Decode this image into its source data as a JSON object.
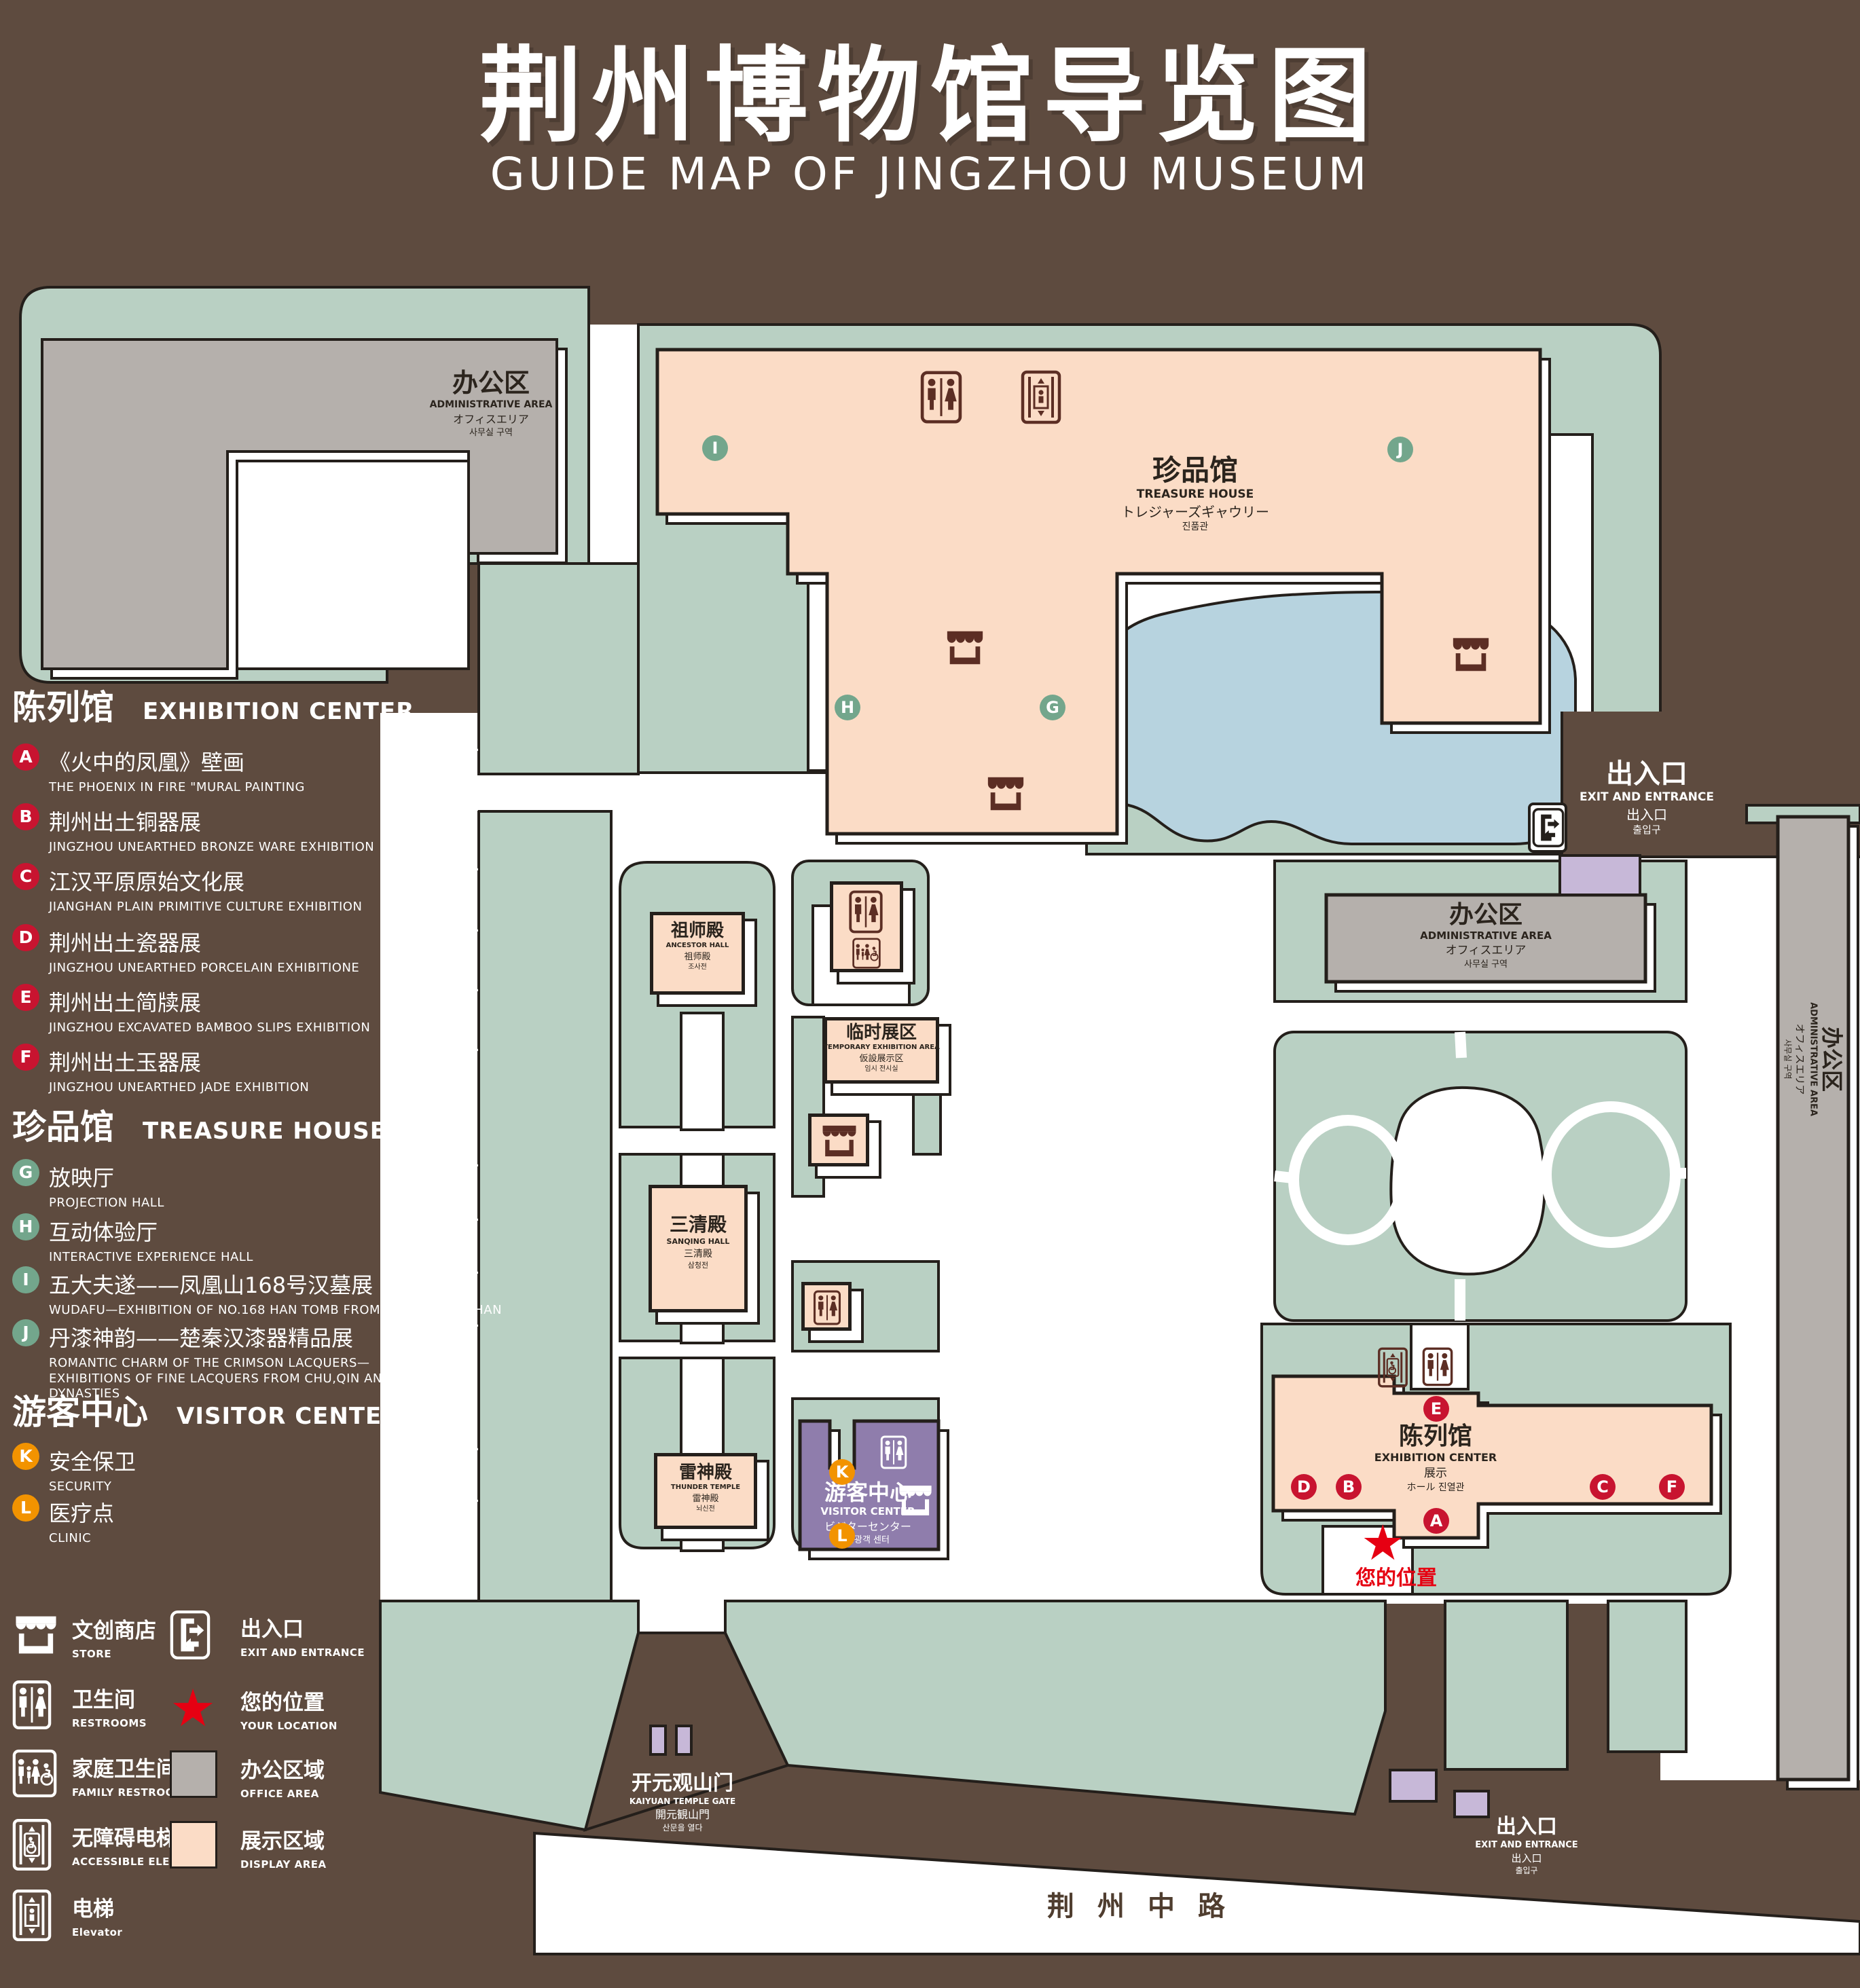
{
  "title": {
    "zh": "荆州博物馆导览图",
    "en": "GUIDE MAP OF JINGZHOU MUSEUM"
  },
  "colors": {
    "background": "#5E4B3F",
    "grounds_green": "#B9D0C3",
    "display_area": "#FBDCC6",
    "office_area": "#B5B0AC",
    "lake_blue": "#B7D3DF",
    "visitor_purple": "#8F7DAC",
    "gate_purple": "#C7B8D8",
    "marker_red": "#C81430",
    "marker_green": "#73A68C",
    "marker_orange": "#F29300",
    "location_red": "#E60012",
    "outline": "#241f1b"
  },
  "legend": {
    "sections": [
      {
        "zh": "陈列馆",
        "en": "EXHIBITION CENTER",
        "color": "#C81430",
        "items": [
          {
            "letter": "A",
            "zh": "《火中的凤凰》壁画",
            "en": "THE PHOENIX IN FIRE \"MURAL PAINTING",
            "floor": "1F"
          },
          {
            "letter": "B",
            "zh": "荆州出土铜器展",
            "en": "JINGZHOU UNEARTHED BRONZE WARE EXHIBITION",
            "floor": "1F"
          },
          {
            "letter": "C",
            "zh": "江汉平原原始文化展",
            "en": "JIANGHAN PLAIN PRIMITIVE CULTURE EXHIBITION",
            "floor": "1F"
          },
          {
            "letter": "D",
            "zh": "荆州出土瓷器展",
            "en": "JINGZHOU UNEARTHED PORCELAIN EXHIBITIONE",
            "floor": "2F"
          },
          {
            "letter": "E",
            "zh": "荆州出土简牍展",
            "en": "JINGZHOU EXCAVATED BAMBOO SLIPS EXHIBITION",
            "floor": "2F"
          },
          {
            "letter": "F",
            "zh": "荆州出土玉器展",
            "en": "JINGZHOU UNEARTHED JADE EXHIBITION",
            "floor": "2F"
          }
        ]
      },
      {
        "zh": "珍品馆",
        "en": "TREASURE HOUSE",
        "color": "#73A68C",
        "items": [
          {
            "letter": "G",
            "zh": "放映厅",
            "en": "PROJECTION HALL",
            "floor": "1F"
          },
          {
            "letter": "H",
            "zh": "互动体验厅",
            "en": "INTERACTIVE EXPERIENCE HALL",
            "floor": "1F"
          },
          {
            "letter": "I",
            "zh": "五大夫遂——凤凰山168号汉墓展",
            "en": "WUDAFU—EXHIBITION OF NO.168 HAN TOMB FROM FENGHUANGSHAN",
            "floor": "2F"
          },
          {
            "letter": "J",
            "zh": "丹漆神韵——楚秦汉漆器精品展",
            "en": "ROMANTIC CHARM OF THE CRIMSON LACQUERS—EXHIBITIONS OF FINE LACQUERS FROM CHU,QIN AND HAN DYNASTIES",
            "floor": "1-2F"
          }
        ]
      },
      {
        "zh": "游客中心",
        "en": "VISITOR CENTER",
        "color": "#F29300",
        "items": [
          {
            "letter": "K",
            "zh": "安全保卫",
            "en": "SECURITY",
            "floor": "1F"
          },
          {
            "letter": "L",
            "zh": "医疗点",
            "en": "CLINIC",
            "floor": "1F"
          }
        ]
      }
    ],
    "facilities_left": [
      {
        "icon": "store-icon",
        "zh": "文创商店",
        "en": "STORE"
      },
      {
        "icon": "restrooms-icon",
        "zh": "卫生间",
        "en": "RESTROOMS"
      },
      {
        "icon": "family-restrooms-icon",
        "zh": "家庭卫生间",
        "en": "FAMILY RESTROOMS"
      },
      {
        "icon": "accessible-elevator-icon",
        "zh": "无障碍电梯",
        "en": "ACCESSIBLE ELEVATOR"
      },
      {
        "icon": "elevator-icon",
        "zh": "电梯",
        "en": "Elevator"
      }
    ],
    "facilities_right": [
      {
        "icon": "exit-icon",
        "zh": "出入口",
        "en": "EXIT AND ENTRANCE"
      },
      {
        "icon": "location-star",
        "zh": "您的位置",
        "en": "YOUR LOCATION"
      },
      {
        "icon": "office-swatch",
        "zh": "办公区域",
        "en": "OFFICE AREA"
      },
      {
        "icon": "display-swatch",
        "zh": "展示区域",
        "en": "DISPLAY AREA"
      }
    ]
  },
  "map": {
    "admin": {
      "zh": "办公区",
      "en": "ADMINISTRATIVE AREA",
      "ja": "オフィスエリア",
      "ko": "사무실 구역"
    },
    "treasure": {
      "zh": "珍品馆",
      "en": "TREASURE HOUSE",
      "ja": "トレジャーズギャウリー",
      "ko": "진품관"
    },
    "ancestor": {
      "zh": "祖师殿",
      "en": "ANCESTOR HALL",
      "ja": "祖师殿",
      "ko": "조사전"
    },
    "sanqing": {
      "zh": "三清殿",
      "en": "SANQING HALL",
      "ja": "三清殿",
      "ko": "삼청전"
    },
    "thunder": {
      "zh": "雷神殿",
      "en": "THUNDER TEMPLE",
      "ja": "雷神殿",
      "ko": "뇌신전"
    },
    "temporary": {
      "zh": "临时展区",
      "en": "TEMPORARY EXHIBITION AREA",
      "ja": "仮設展示区",
      "ko": "임시 전시실"
    },
    "visitor": {
      "zh": "游客中心",
      "en": "VISITOR CENTER",
      "ja": "ビジターセンター",
      "ko": "관광객 센터"
    },
    "exhibition": {
      "zh": "陈列馆",
      "en": "EXHIBITION CENTER",
      "ja": "展示",
      "ko": "ホール 진열관"
    },
    "gate": {
      "zh": "开元观山门",
      "en": "KAIYUAN TEMPLE GATE",
      "ja": "開元観山門",
      "ko": "산문을 열다"
    },
    "exit": {
      "zh": "出入口",
      "en": "EXIT AND ENTRANCE",
      "ja": "出入口",
      "ko": "출입구"
    },
    "your_location": "您的位置",
    "road": "荆州中路"
  }
}
